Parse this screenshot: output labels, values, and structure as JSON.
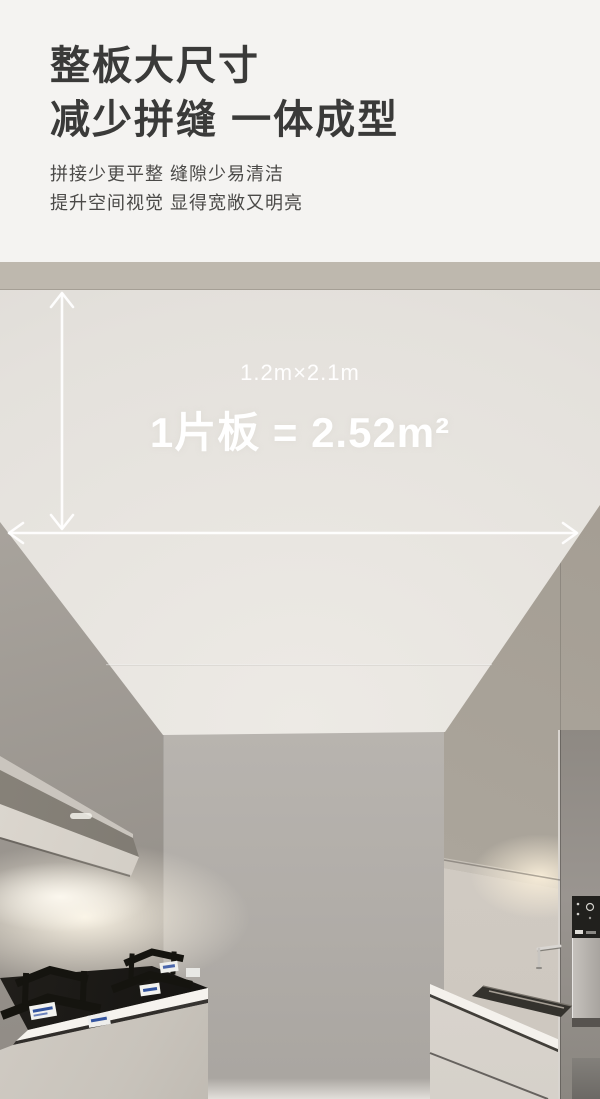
{
  "header": {
    "title_line1": "整板大尺寸",
    "title_line2": "减少拼缝 一体成型",
    "subtitle_line1": "拼接少更平整 缝隙少易清洁",
    "subtitle_line2": "提升空间视觉 显得宽敞又明亮"
  },
  "photo": {
    "dimension_label": "1.2m×2.1m",
    "area_label": "1片板 = 2.52m²"
  },
  "palette": {
    "page_background": "#f4f3f1",
    "heading_text": "#3a3a39",
    "body_text": "#4b4a48",
    "ceiling": "#e4e1dc",
    "wall_band": "#beb8ae",
    "left_wall": "#938e88",
    "back_wall": "#b0aca7",
    "cabinets": "#aaa49a",
    "annotation_text": "#ffffff"
  }
}
